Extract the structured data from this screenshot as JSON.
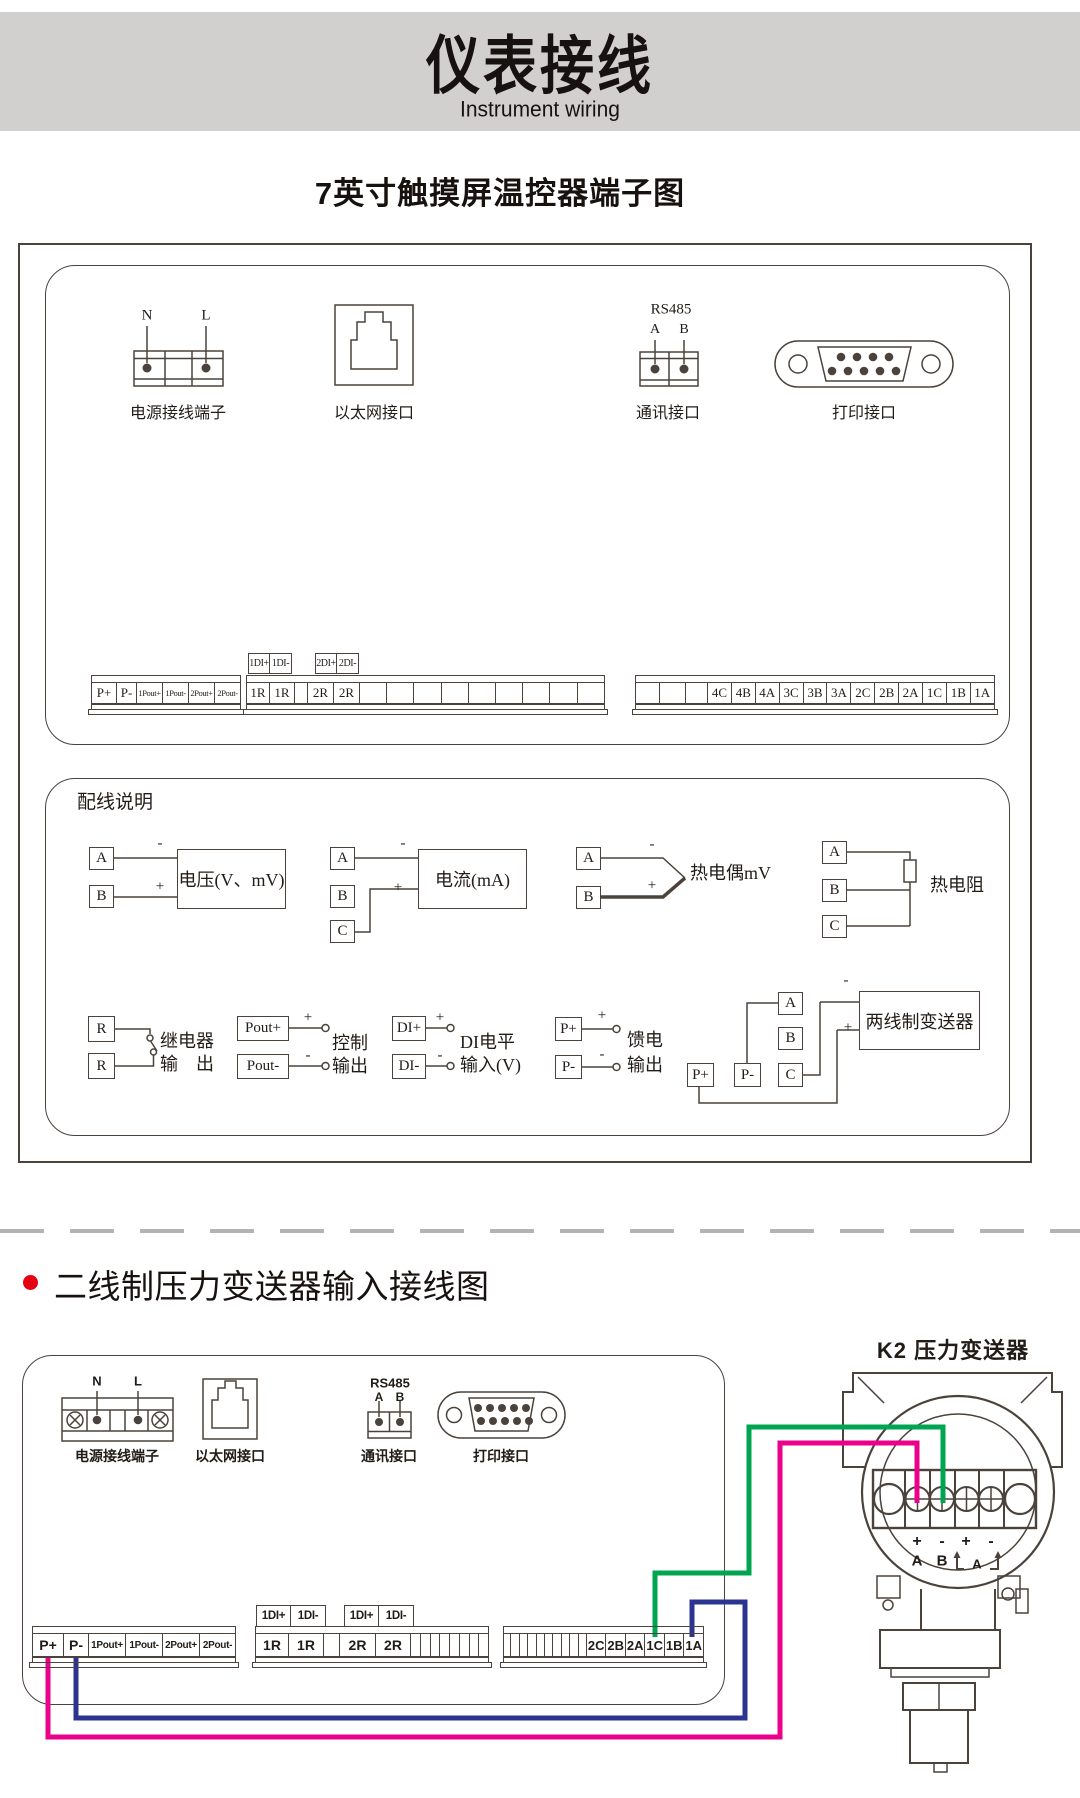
{
  "banner": {
    "title": "仪表接线",
    "subtitle": "Instrument wiring",
    "bg": "#d2d0cf"
  },
  "section1": {
    "title": "7英寸触摸屏温控器端子图",
    "power": {
      "n": "N",
      "l": "L",
      "caption": "电源接线端子"
    },
    "ethernet": {
      "caption": "以太网接口"
    },
    "rs485": {
      "title": "RS485",
      "a": "A",
      "b": "B",
      "caption": "通讯接口"
    },
    "printer": {
      "caption": "打印接口"
    },
    "strip_left": [
      "P+",
      "P-",
      "1Pout+",
      "1Pout-",
      "2Pout+",
      "2Pout-"
    ],
    "di_block1": [
      "1DI+",
      "1DI-"
    ],
    "di_block2": [
      "2DI+",
      "2DI-"
    ],
    "strip_mid": [
      "1R",
      "1R",
      "",
      "2R",
      "2R",
      "",
      "",
      "",
      "",
      "",
      "",
      "",
      "",
      ""
    ],
    "strip_right": [
      "",
      "",
      "",
      "4C",
      "4B",
      "4A",
      "3C",
      "3B",
      "3A",
      "2C",
      "2B",
      "2A",
      "1C",
      "1B",
      "1A"
    ]
  },
  "section2": {
    "title": "配线说明",
    "voltage": {
      "a": "A",
      "b": "B",
      "minus": "-",
      "plus": "+",
      "box": "电压(V、mV)"
    },
    "current": {
      "a": "A",
      "b": "B",
      "c": "C",
      "minus": "-",
      "plus": "+",
      "box": "电流(mA)"
    },
    "thermocouple": {
      "a": "A",
      "b": "B",
      "minus": "-",
      "plus": "+",
      "label": "热电偶mV"
    },
    "rtd": {
      "a": "A",
      "b": "B",
      "c": "C",
      "label": "热电阻"
    },
    "relay": {
      "r1": "R",
      "r2": "R",
      "label1": "继电器",
      "label2": "输　出"
    },
    "control": {
      "t1": "Pout+",
      "t2": "Pout-",
      "plus": "+",
      "minus": "-",
      "label1": "控制",
      "label2": "输出"
    },
    "di": {
      "t1": "DI+",
      "t2": "DI-",
      "plus": "+",
      "minus": "-",
      "label1": "DI电平",
      "label2": "输入(V)"
    },
    "feed": {
      "t1": "P+",
      "t2": "P-",
      "plus": "+",
      "minus": "-",
      "label1": "馈电",
      "label2": "输出"
    },
    "twowire": {
      "p1": "P+",
      "p2": "P-",
      "a": "A",
      "b": "B",
      "c": "C",
      "minus": "-",
      "plus": "+",
      "box": "两线制变送器"
    }
  },
  "section3": {
    "title": "二线制压力变送器输入接线图",
    "bullet_color": "#e60014",
    "k2_label": "K2 压力变送器",
    "power": {
      "n": "N",
      "l": "L",
      "caption": "电源接线端子"
    },
    "ethernet": {
      "caption": "以太网接口"
    },
    "rs485": {
      "title": "RS485",
      "a": "A",
      "b": "B",
      "caption": "通讯接口"
    },
    "printer": {
      "caption": "打印接口"
    },
    "strip_left": [
      "P+",
      "P-",
      "1Pout+",
      "1Pout-",
      "2Pout+",
      "2Pout-"
    ],
    "di_block1": [
      "1DI+",
      "1DI-"
    ],
    "di_block2": [
      "1DI+",
      "1DI-"
    ],
    "strip_mid": [
      "1R",
      "1R",
      "",
      "2R",
      "2R",
      "",
      "",
      "",
      "",
      "",
      "",
      "",
      ""
    ],
    "strip_right": [
      "",
      "",
      "",
      "",
      "",
      "",
      "",
      "",
      "",
      "",
      "2C",
      "2B",
      "2A",
      "1C",
      "1B",
      "1A"
    ],
    "transmitter": {
      "signs": [
        "+",
        "-",
        "+",
        "-"
      ],
      "pins": [
        "A",
        "B",
        "A"
      ]
    },
    "wires": {
      "green": "#00a551",
      "pink": "#eb008b",
      "blue": "#2b3490"
    }
  }
}
